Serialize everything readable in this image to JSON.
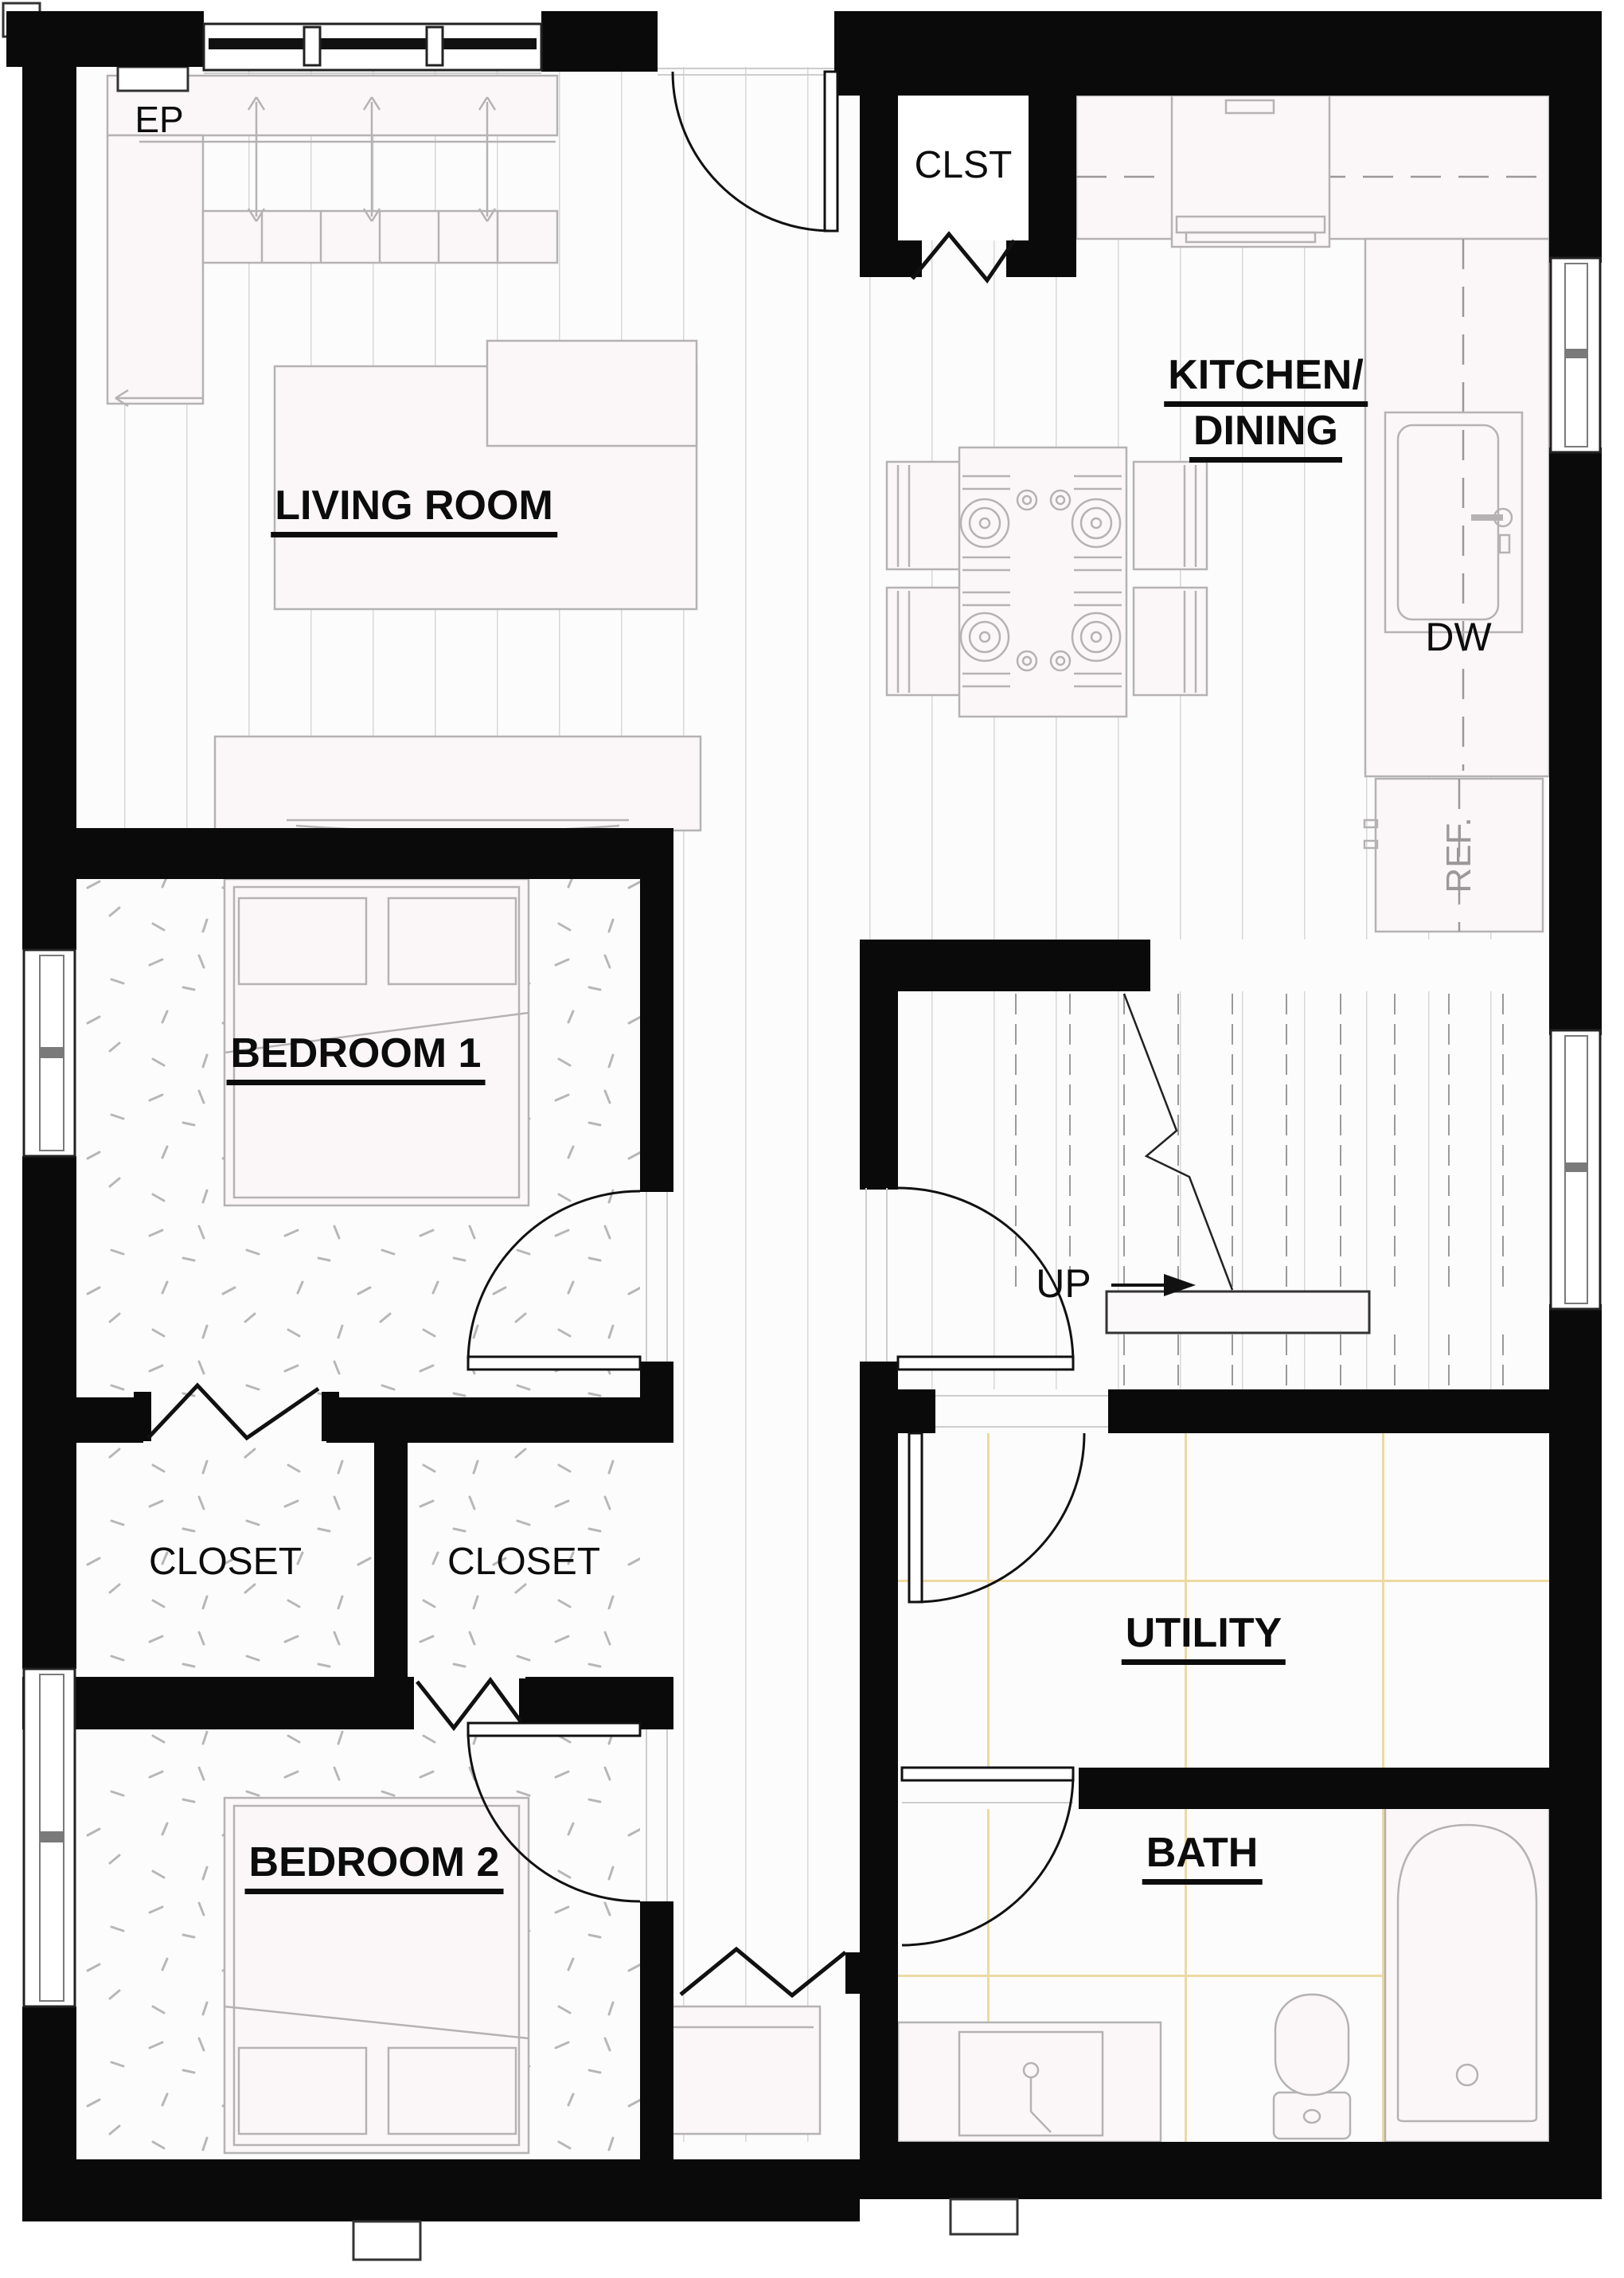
{
  "floorplan": {
    "labels": {
      "ep": "EP",
      "clst": "CLST",
      "kitchen_line1": "KITCHEN/",
      "kitchen_line2": "DINING",
      "living": "LIVING ROOM",
      "dw": "DW",
      "ref": "REF.",
      "bedroom1": "BEDROOM 1",
      "up": "UP",
      "closet_left": "CLOSET",
      "closet_right": "CLOSET",
      "bedroom2": "BEDROOM 2",
      "utility": "UTILITY",
      "bath": "BATH"
    },
    "colors": {
      "wall": "#0a0a0a",
      "text": "#0c0c0c",
      "ref_text": "#9b9899",
      "furniture_stroke": "#b5b2b3",
      "furniture_fill": "#fbf7f8",
      "plank_line": "#d9d6d7",
      "carpet_mark": "#b9b6b7",
      "tile_line": "#eddaa2",
      "door": "#111111"
    }
  }
}
